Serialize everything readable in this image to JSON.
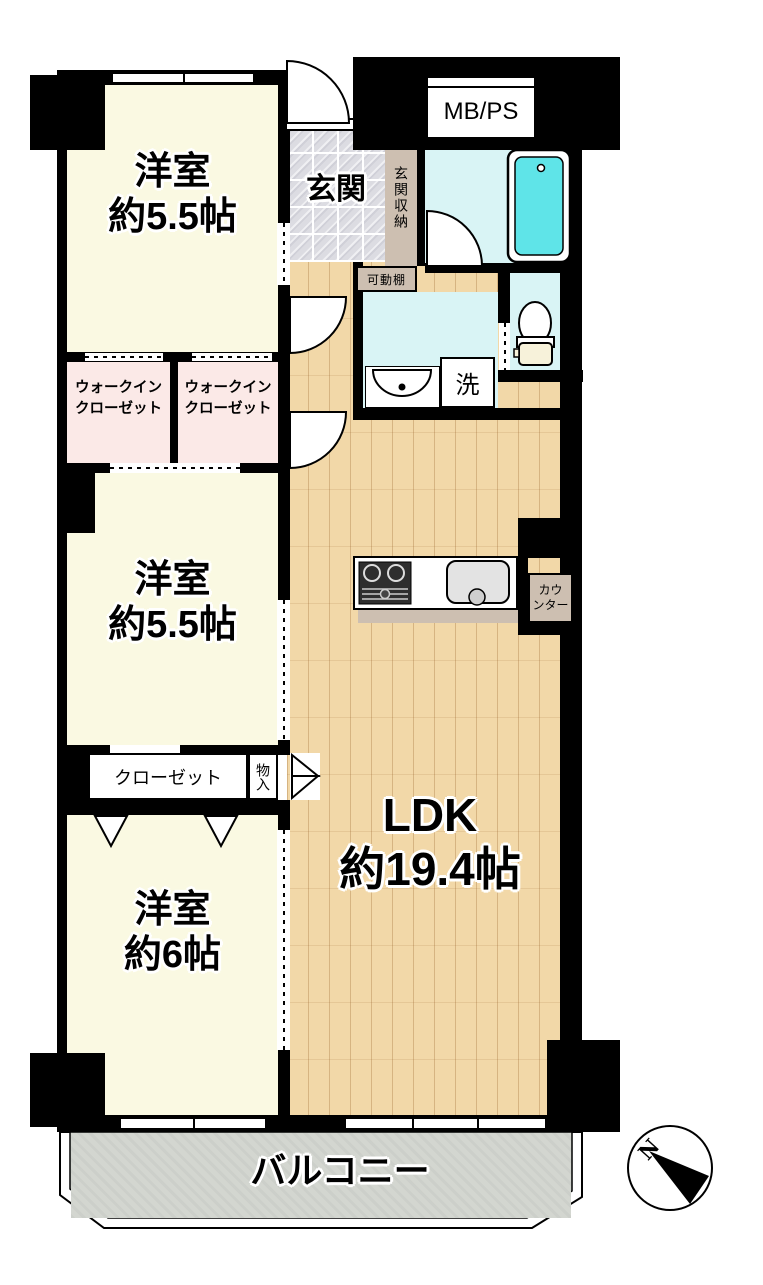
{
  "floorplan": {
    "rooms": {
      "bedroom1": {
        "name": "洋室",
        "area": "約5.5帖"
      },
      "bedroom2": {
        "name": "洋室",
        "area": "約5.5帖"
      },
      "bedroom3": {
        "name": "洋室",
        "area": "約6帖"
      },
      "ldk": {
        "name": "LDK",
        "area": "約19.4帖"
      },
      "entrance": {
        "label": "玄関"
      },
      "entrance_storage": {
        "label": "玄関収納"
      },
      "movable_shelf": {
        "label": "可動棚"
      },
      "laundry": {
        "label": "洗"
      },
      "counter": {
        "line1": "カウ",
        "line2": "ンター"
      },
      "wic1": {
        "line1": "ウォークイン",
        "line2": "クローゼット"
      },
      "wic2": {
        "line1": "ウォークイン",
        "line2": "クローゼット"
      },
      "closet": {
        "label": "クローゼット"
      },
      "storage": {
        "label": "物入"
      },
      "mb_ps": {
        "label": "MB/PS"
      },
      "balcony": {
        "label": "バルコニー"
      }
    },
    "compass": {
      "north_label": "N"
    },
    "colors": {
      "room_cream": "#FAF9E2",
      "closet_pink": "#FBE9E7",
      "wet_area_cyan": "#D9F4F5",
      "bathtub_cyan": "#5FE4E8",
      "wood_floor": "#F2D8A8",
      "tile_gray": "#DCDCE2",
      "storage_tan": "#CDBFB1",
      "balcony_gray": "#D3D6D0",
      "wall_black": "#000000"
    }
  }
}
